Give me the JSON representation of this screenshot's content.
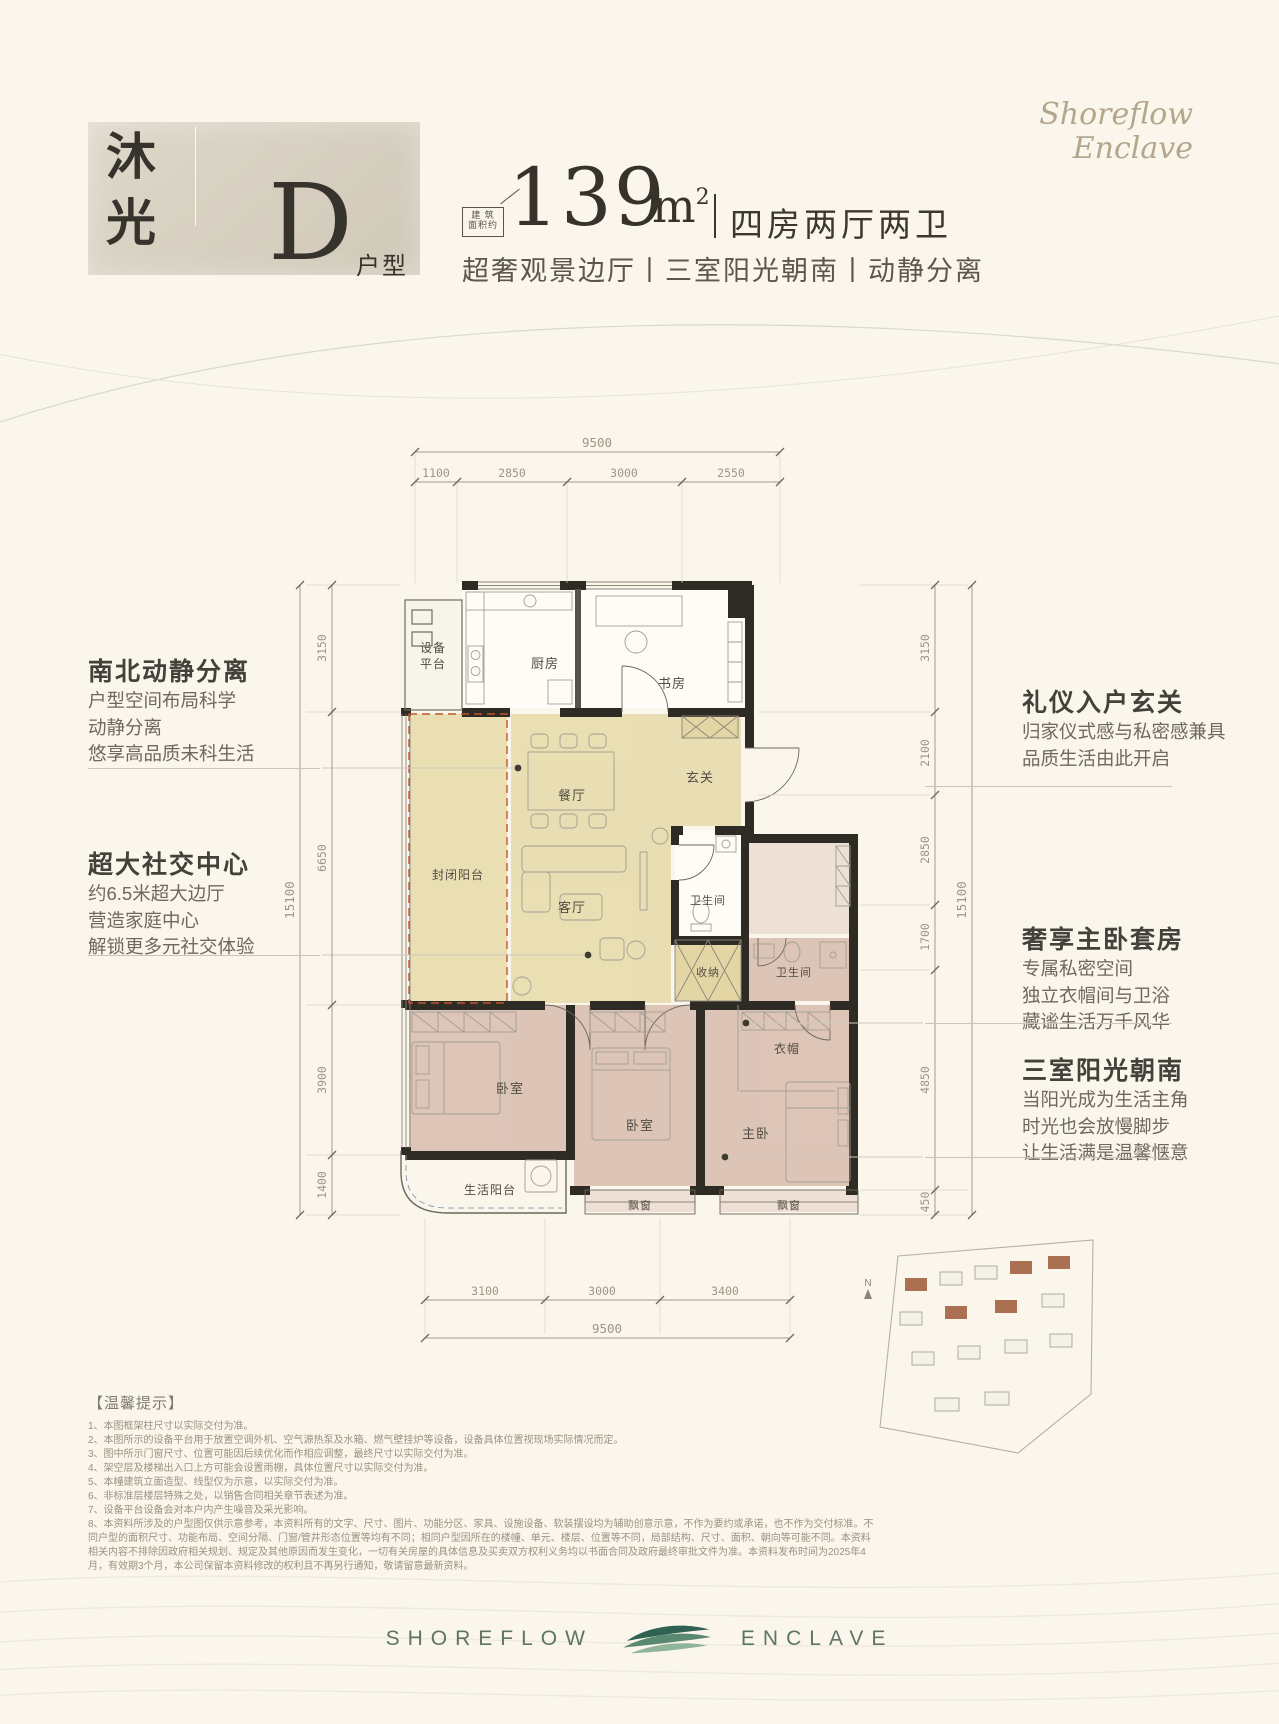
{
  "header": {
    "brand_cn": {
      "char1": "沐",
      "char2": "光",
      "unit_letter": "D",
      "unit_suffix": "户型"
    },
    "stamp": {
      "row1": "建 筑",
      "row2": "面积约"
    },
    "area": {
      "value": "139",
      "unit_base": "m",
      "unit_sup": "2"
    },
    "layout_summary": "四房两厅两卫",
    "subtitle": "超奢观景边厅丨三室阳光朝南丨动静分离",
    "brand_en_line1": "Shoreflow",
    "brand_en_line2": "Enclave"
  },
  "annotations": {
    "left": [
      {
        "title": "南北动静分离",
        "lines": [
          "户型空间布局科学",
          "动静分离",
          "悠享高品质未科生活"
        ]
      },
      {
        "title": "超大社交中心",
        "lines": [
          "约6.5米超大边厅",
          "营造家庭中心",
          "解锁更多元社交体验"
        ]
      }
    ],
    "right": [
      {
        "title": "礼仪入户玄关",
        "lines": [
          "归家仪式感与私密感兼具",
          "品质生活由此开启"
        ]
      },
      {
        "title": "奢享主卧套房",
        "lines": [
          "专属私密空间",
          "独立衣帽间与卫浴",
          "藏谧生活万千风华"
        ]
      },
      {
        "title": "三室阳光朝南",
        "lines": [
          "当阳光成为生活主角",
          "时光也会放慢脚步",
          "让生活满是温馨惬意"
        ]
      }
    ]
  },
  "floorplan": {
    "rooms": {
      "equipment_platform": [
        "设备",
        "平台"
      ],
      "kitchen": "厨房",
      "study": "书房",
      "foyer": "玄关",
      "dining": "餐厅",
      "enclosed_balcony": "封闭阳台",
      "living": "客厅",
      "bath_1": "卫生间",
      "storage": "收纳",
      "bath_2": "卫生间",
      "cloakroom": "衣帽",
      "bedroom_1": "卧室",
      "bedroom_2": "卧室",
      "master": "主卧",
      "life_balcony": "生活阳台",
      "bay_window_1": "飘窗",
      "bay_window_2": "飘窗"
    },
    "dims": {
      "top_total": "9500",
      "top": [
        "1100",
        "2850",
        "3000",
        "2550"
      ],
      "left": [
        "3150",
        "6650",
        "3900",
        "1400"
      ],
      "left_total": "15100",
      "right": [
        "3150",
        "2100",
        "2850",
        "1700",
        "4850",
        "450"
      ],
      "right_total": "15100",
      "bottom": [
        "3100",
        "3000",
        "3400"
      ],
      "bottom_total": "9500"
    }
  },
  "siteplan": {
    "north": "N"
  },
  "notice": {
    "title": "【温馨提示】",
    "items": [
      "1、本图框架柱尺寸以实际交付为准。",
      "2、本图所示的设备平台用于放置空调外机、空气源热泵及水箱、燃气壁挂炉等设备，设备具体位置视现场实际情况而定。",
      "3、图中所示门窗尺寸、位置可能因后续优化而作相应调整，最终尺寸以实际交付为准。",
      "4、架空层及楼梯出入口上方可能会设置雨棚，具体位置尺寸以实际交付为准。",
      "5、本幢建筑立面造型、线型仅为示意，以实际交付为准。",
      "6、非标准层楼层特殊之处，以销售合同相关章节表述为准。",
      "7、设备平台设备会对本户内产生噪音及采光影响。",
      "8、本资料所涉及的户型图仅供示意参考，本资料所有的文字、尺寸、图片、功能分区、家具、设施设备、软装摆设均为辅助创意示意，不作为要约或承诺，也不作为交付标准。不同户型的面积尺寸、功能布局、空间分隔、门窗/管井形态位置等均有不同；相同户型因所在的楼幢、单元、楼层、位置等不同，局部结构、尺寸、面积、朝向等可能不同。本资料相关内容不排除因政府相关规划、规定及其他原因而发生变化，一切有关房屋的具体信息及买卖双方权利义务均以书面合同及政府最终审批文件为准。本资料发布时间为2025年4月，有效期3个月，本公司保留本资料修改的权利且不再另行通知，敬请留意最新资料。"
    ]
  },
  "footer": {
    "left": "SHOREFLOW",
    "right": "ENCLAVE"
  }
}
